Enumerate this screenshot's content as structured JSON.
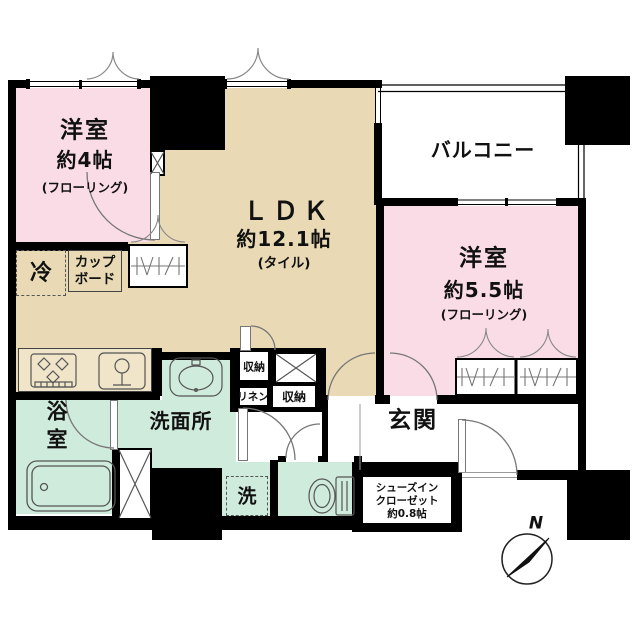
{
  "rooms": {
    "bedroom4": {
      "label": "洋室",
      "size": "約4帖",
      "floor_note": "(フローリング)"
    },
    "ldk": {
      "label": "ＬＤＫ",
      "size": "約12.1帖",
      "floor_note": "(タイル)"
    },
    "balcony": {
      "label": "バルコニー"
    },
    "bedroom55": {
      "label": "洋室",
      "size": "約5.5帖",
      "floor_note": "(フローリング)"
    },
    "bathroom": {
      "char1": "浴",
      "char2": "室"
    },
    "washroom": {
      "label": "洗面所"
    },
    "entrance": {
      "label": "玄関"
    },
    "shoe_closet": {
      "line1": "シューズイン",
      "line2": "クローゼット",
      "size": "約0.8帖"
    }
  },
  "storage": {
    "refrigerator_label": "冷",
    "cupboard_line1": "カップ",
    "cupboard_line2": "ボード",
    "storage_upper": "収納",
    "linen": "リネン",
    "storage_lower": "収納",
    "washer_label": "洗"
  },
  "compass": {
    "north_label": "N"
  },
  "colors": {
    "wall": "#000000",
    "bedroom_pink": "#fadce6",
    "ldk_beige": "#e9dab5",
    "wet_green": "#cfebdc",
    "counter_beige": "#f0e5c8",
    "line_gray": "#777777"
  }
}
